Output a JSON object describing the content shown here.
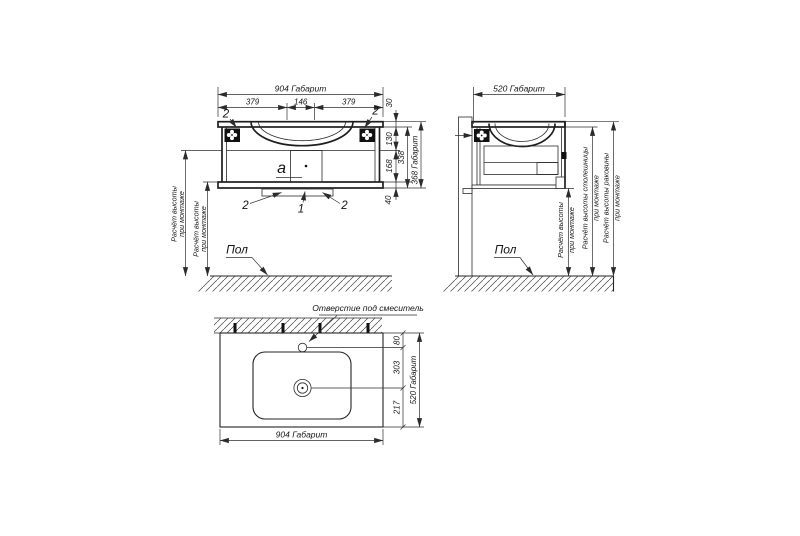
{
  "drawing": {
    "front_view": {
      "width_total": "904 Габарит",
      "width_left": "379",
      "width_center": "146",
      "width_right": "379",
      "h_top": "30",
      "h_upper": "130",
      "h_lower": "168",
      "h_body": "338",
      "h_total": "368 Габарит",
      "h_rail": "40",
      "callout_bracket_left": "2",
      "callout_bracket_right": "2",
      "callout_rail_left": "2",
      "callout_rail_center": "1",
      "callout_rail_right": "2",
      "callout_siphon": "a",
      "mount_height_row1": "Расчёт высоты",
      "mount_height_row2": "при монтаже",
      "floor_label": "Пол"
    },
    "side_view": {
      "depth_total": "520 Габарит",
      "floor_label": "Пол",
      "height_dims": [
        {
          "row1": "Расчёт высоты",
          "row2": "при монтаже"
        },
        {
          "row1": "Расчёт высоты столешницы",
          "row2": "при монтаже"
        },
        {
          "row1": "Расчёт высоты раковины",
          "row2": "при монтаже"
        }
      ]
    },
    "plan_view": {
      "faucet_hole_label": "Отверстие под смеситель",
      "d_faucet": "80",
      "d_drain": "303",
      "d_front": "217",
      "depth_total": "520 Габарит",
      "width_total": "904 Габарит"
    }
  },
  "colors": {
    "line": "#2b2b2b",
    "background": "#ffffff",
    "hatch": "#4a4a4a"
  }
}
